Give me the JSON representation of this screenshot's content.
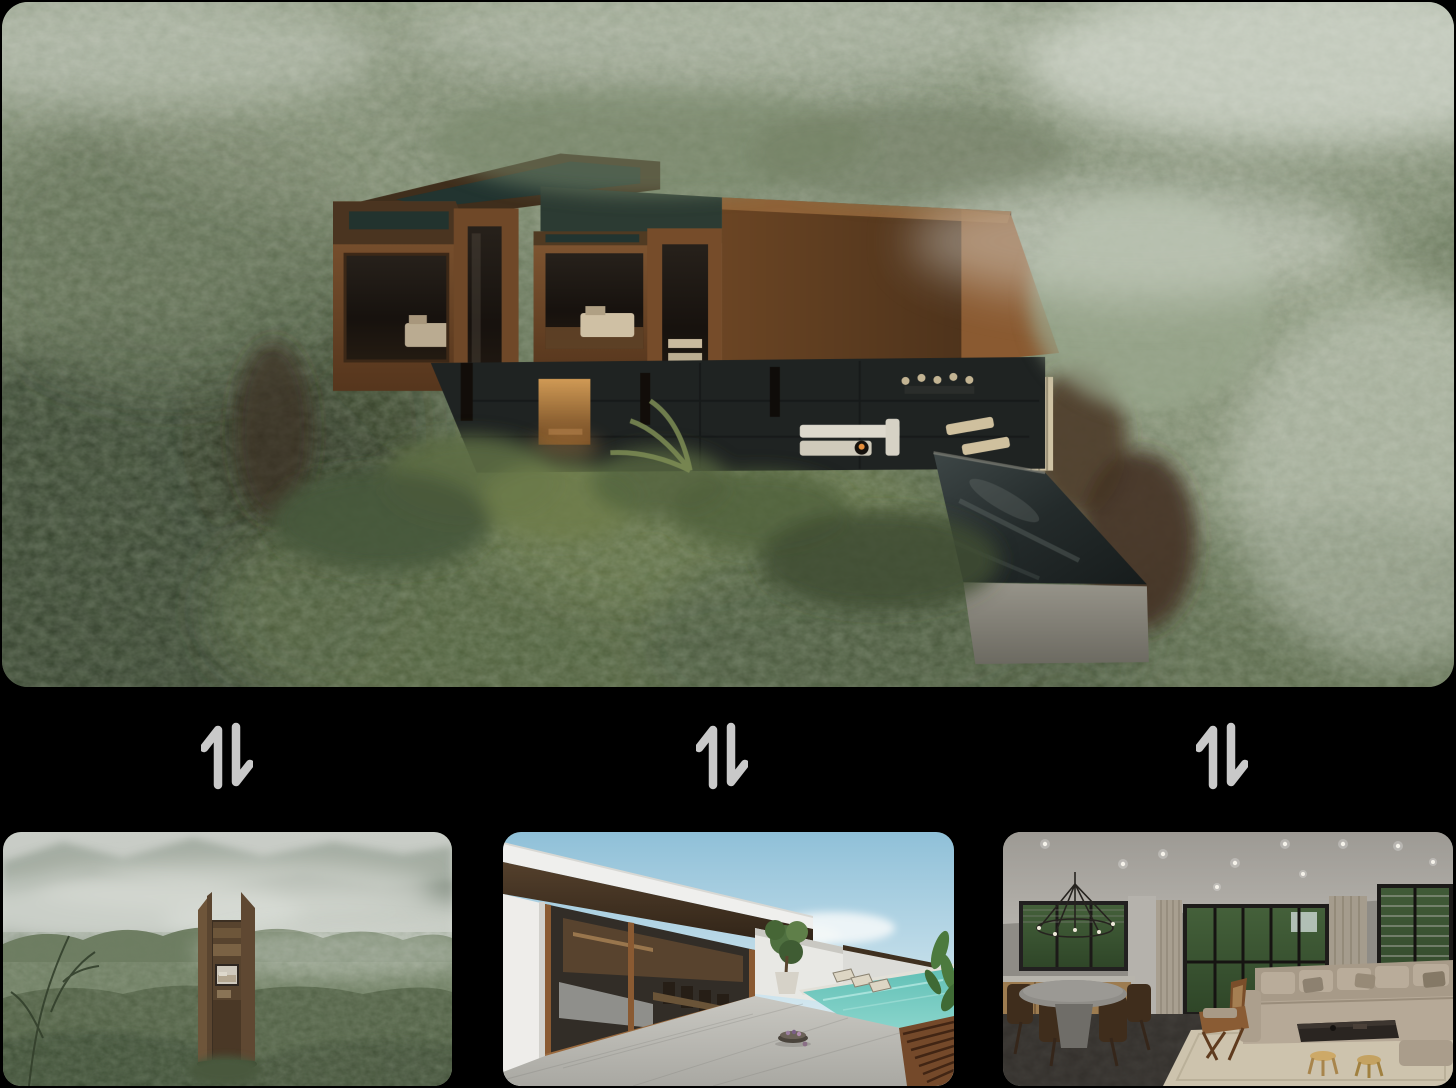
{
  "page": {
    "background_color": "#000000"
  },
  "hero": {
    "alt": "Aerial render of a corten-steel box villa nestled in a misty green forest with a dark stone terrace and cantilevered concrete pool"
  },
  "swap": {
    "label": "Swap image",
    "icon": "swap-vertical-arrows",
    "color": "#c9c9c9"
  },
  "thumbnails": [
    {
      "alt": "Tall wooden tower cabin standing in a foggy green mountain valley"
    },
    {
      "alt": "White modern villa terrace with dark timber roof, turquoise pool and concrete deck under blue sky"
    },
    {
      "alt": "Living room interior with beige sectional sofa, round dining table, chandelier and forest view windows"
    }
  ]
}
